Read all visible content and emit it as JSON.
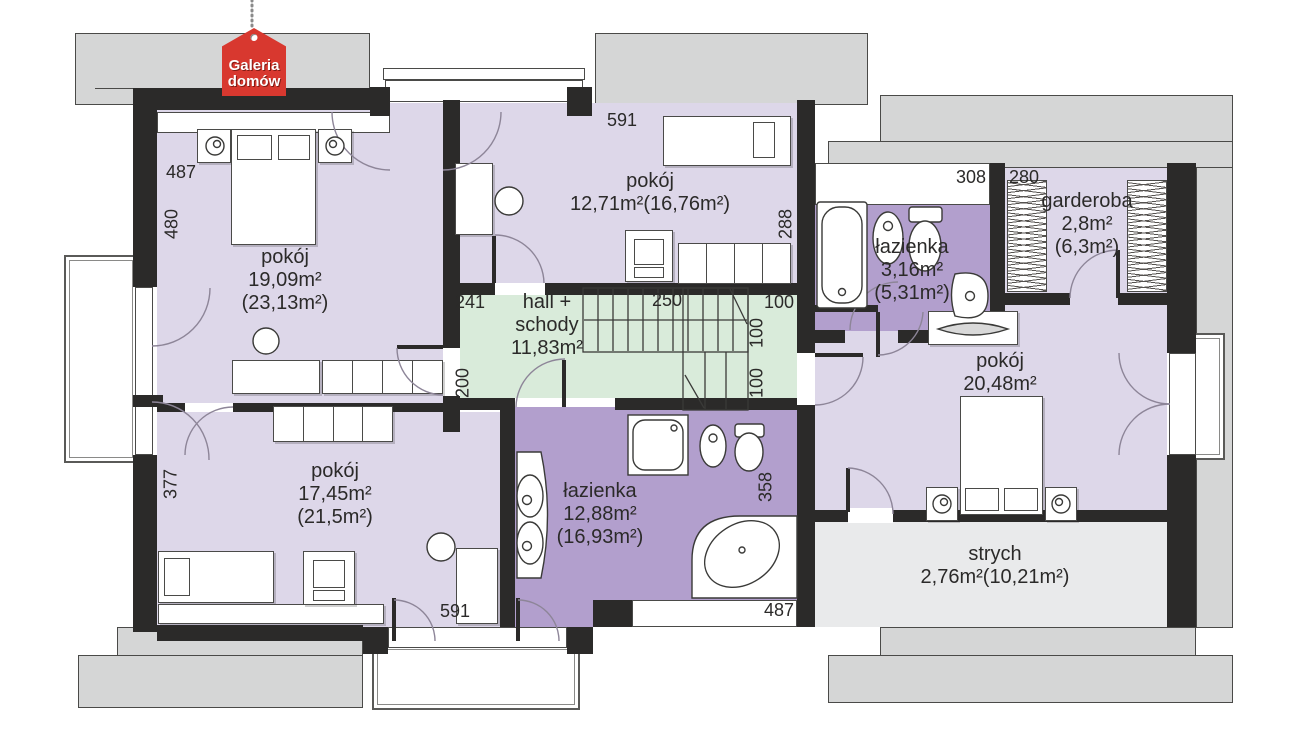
{
  "logo": {
    "line1": "Galeria",
    "line2": "domów",
    "color": "#d8382f"
  },
  "rooms": {
    "pokoj19": {
      "name": "pokój",
      "area": "19,09m²",
      "area_total": "(23,13m²)"
    },
    "pokoj12": {
      "name": "pokój",
      "area": "12,71m²(16,76m²)"
    },
    "hall": {
      "name": "hall +",
      "name2": "schody",
      "area": "11,83m²"
    },
    "lazienka3": {
      "name": "łazienka",
      "area": "3,16m²",
      "area_total": "(5,31m²)"
    },
    "garderoba": {
      "name": "garderoba",
      "area": "2,8m²",
      "area_total": "(6,3m²)"
    },
    "pokoj20": {
      "name": "pokój",
      "area": "20,48m²"
    },
    "pokoj17": {
      "name": "pokój",
      "area": "17,45m²",
      "area_total": "(21,5m²)"
    },
    "lazienka12": {
      "name": "łazienka",
      "area": "12,88m²",
      "area_total": "(16,93m²)"
    },
    "strych": {
      "name": "strych",
      "area": "2,76m²(10,21m²)"
    }
  },
  "dimensions": {
    "left_width": "487",
    "left_height": "480",
    "top_width": "591",
    "room12_depth": "288",
    "hall_241": "241",
    "stairs_250": "250",
    "hall_100a": "100",
    "hall_100b": "100",
    "hall_100c": "100",
    "hall_200": "200",
    "bath3_width": "308",
    "garderoba_width": "280",
    "pokoj17_height": "377",
    "bottom_width": "591",
    "bath12_depth": "358",
    "bath12_width": "487"
  },
  "colors": {
    "room_fill": "#ddd7e9",
    "bath_fill": "#b29fcd",
    "hall_fill": "#d9ebdA",
    "attic_fill": "#e9eaeb",
    "roof_fill": "#d5d6d6",
    "wall": "#2b2a29",
    "logo_red": "#d8382f"
  }
}
